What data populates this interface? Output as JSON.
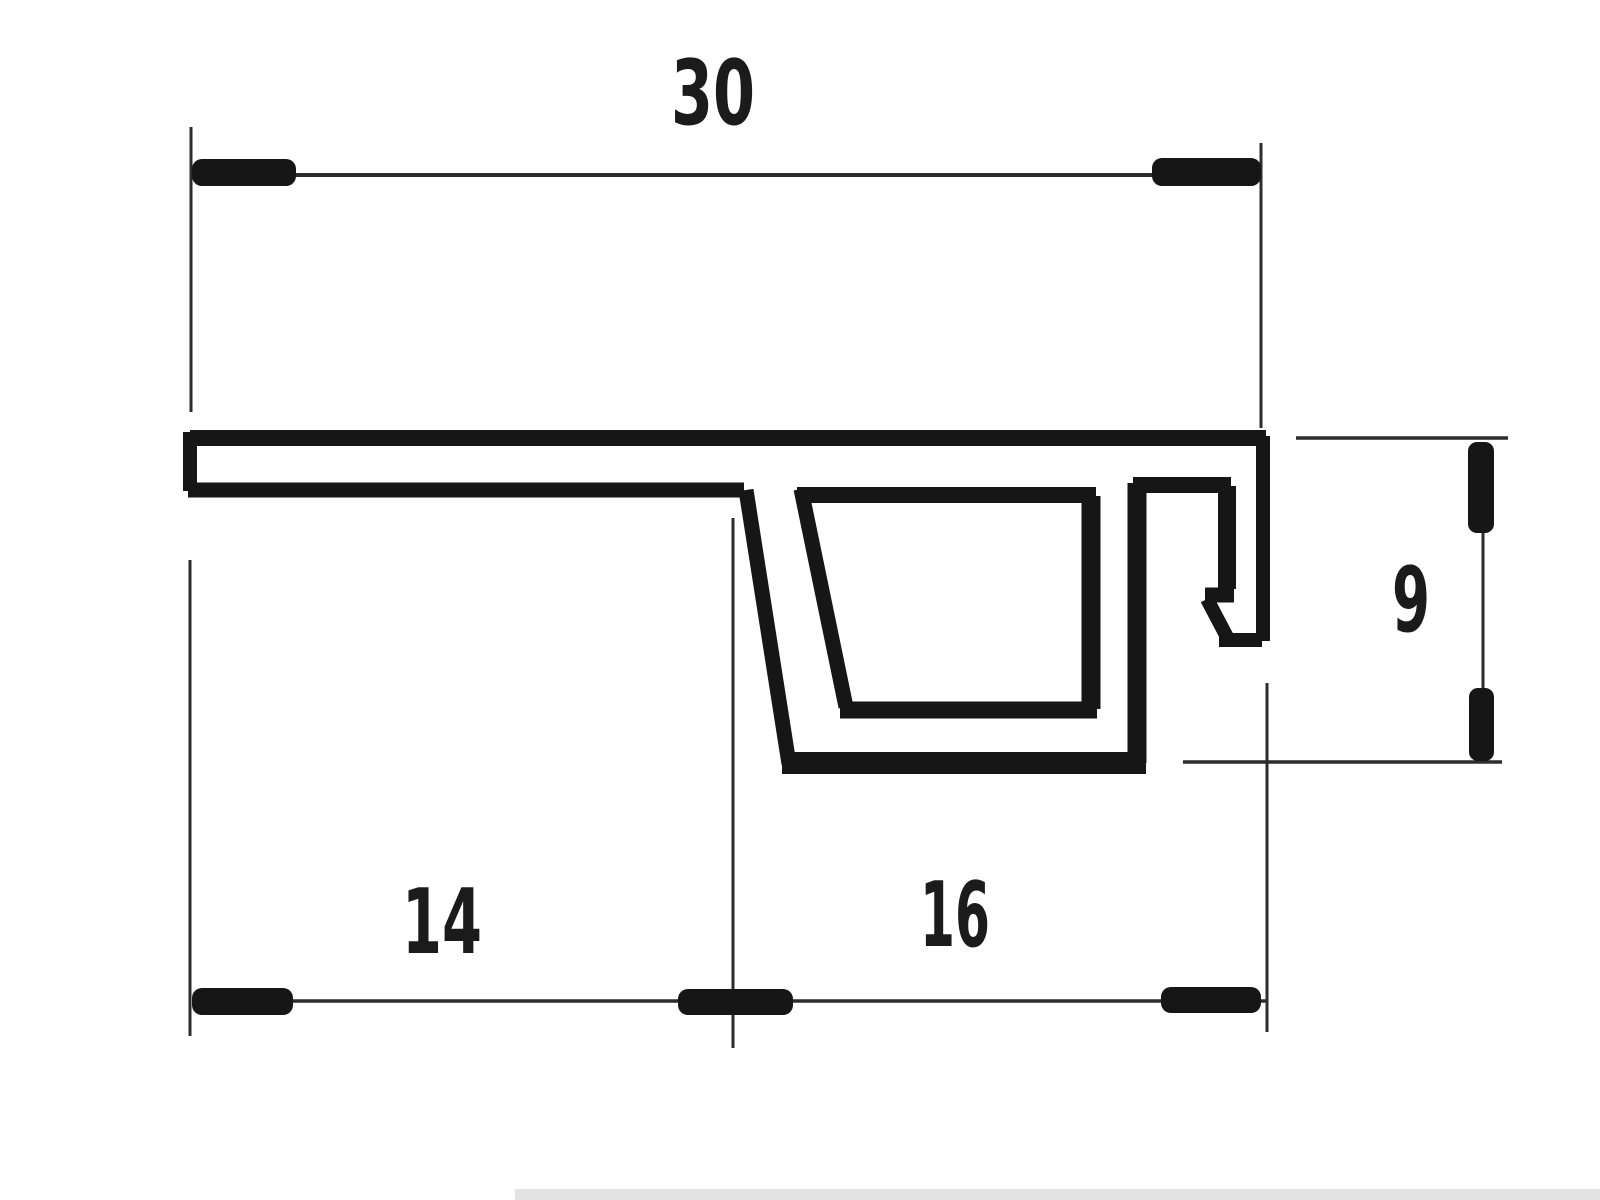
{
  "page": {
    "background": "#ffffff",
    "ink": "#161616",
    "thin_ink": "#2d2d2d",
    "label_color": "#1b1b1b",
    "shadow_color": "#d9d9d9"
  },
  "drawing": {
    "type": "technical-dimension-drawing",
    "subject": "extruded-profile-cross-section",
    "dimensions": [
      {
        "name": "overall-width",
        "value": "30"
      },
      {
        "name": "left-span",
        "value": "14"
      },
      {
        "name": "right-span",
        "value": "16"
      },
      {
        "name": "right-height",
        "value": "9"
      }
    ]
  },
  "labels": [
    {
      "id": "dimension-label-30",
      "text": "30",
      "x": 713,
      "baseline": 124,
      "font_size": 90,
      "text_length": 84
    },
    {
      "id": "dimension-label-14",
      "text": "14",
      "x": 442,
      "baseline": 953,
      "font_size": 90,
      "text_length": 80
    },
    {
      "id": "dimension-label-16",
      "text": "16",
      "x": 955,
      "baseline": 946,
      "font_size": 90,
      "text_length": 70
    },
    {
      "id": "dimension-label-9",
      "text": "9",
      "x": 1411,
      "baseline": 631,
      "font_size": 90,
      "text_length": 38
    }
  ],
  "profile_strokes": [
    {
      "name": "profile-top-edge",
      "x1": 190,
      "y1": 438,
      "x2": 1266,
      "y2": 438,
      "w": 16
    },
    {
      "name": "profile-left-end-cap",
      "x1": 190,
      "y1": 432,
      "x2": 190,
      "y2": 491,
      "w": 14
    },
    {
      "name": "flange-bottom-edge",
      "x1": 188,
      "y1": 490,
      "x2": 744,
      "y2": 490,
      "w": 15
    },
    {
      "name": "channel-left-wall-outer",
      "x1": 746,
      "y1": 490,
      "x2": 789,
      "y2": 764,
      "w": 15
    },
    {
      "name": "channel-bottom-outer",
      "x1": 782,
      "y1": 763,
      "x2": 1146,
      "y2": 763,
      "w": 22
    },
    {
      "name": "channel-right-wall-outer",
      "x1": 1137,
      "y1": 763,
      "x2": 1137,
      "y2": 483,
      "w": 19
    },
    {
      "name": "channel-left-wall-inner",
      "x1": 801,
      "y1": 489,
      "x2": 846,
      "y2": 707,
      "w": 15
    },
    {
      "name": "channel-top-edge-inner",
      "x1": 797,
      "y1": 495,
      "x2": 1096,
      "y2": 495,
      "w": 16
    },
    {
      "name": "channel-bottom-inner",
      "x1": 840,
      "y1": 710,
      "x2": 1097,
      "y2": 710,
      "w": 17
    },
    {
      "name": "channel-right-wall-inner",
      "x1": 1091,
      "y1": 496,
      "x2": 1091,
      "y2": 709,
      "w": 19
    },
    {
      "name": "hook-top-bar",
      "x1": 1133,
      "y1": 485,
      "x2": 1231,
      "y2": 485,
      "w": 16
    },
    {
      "name": "hook-inner-vertical",
      "x1": 1227,
      "y1": 486,
      "x2": 1227,
      "y2": 589,
      "w": 18
    },
    {
      "name": "hook-barb-step",
      "x1": 1205,
      "y1": 595,
      "x2": 1234,
      "y2": 595,
      "w": 15
    },
    {
      "name": "hook-barb-diagonal",
      "x1": 1207,
      "y1": 599,
      "x2": 1227,
      "y2": 637,
      "w": 14
    },
    {
      "name": "hook-foot",
      "x1": 1219,
      "y1": 640,
      "x2": 1262,
      "y2": 640,
      "w": 14
    },
    {
      "name": "profile-right-wall",
      "x1": 1263,
      "y1": 641,
      "x2": 1263,
      "y2": 436,
      "w": 14
    }
  ],
  "thin_lines": [
    {
      "name": "dimension-line-30",
      "x1": 194,
      "y1": 175,
      "x2": 1262,
      "y2": 175,
      "w": 4
    },
    {
      "name": "extension-line-30-left",
      "x1": 191,
      "y1": 127,
      "x2": 191,
      "y2": 412,
      "w": 3
    },
    {
      "name": "extension-line-30-right",
      "x1": 1261,
      "y1": 143,
      "x2": 1261,
      "y2": 428,
      "w": 3
    },
    {
      "name": "dimension-line-bottom",
      "x1": 192,
      "y1": 1001,
      "x2": 1266,
      "y2": 1001,
      "w": 3.5
    },
    {
      "name": "extension-line-bottom-left",
      "x1": 190,
      "y1": 560,
      "x2": 190,
      "y2": 1036,
      "w": 3
    },
    {
      "name": "extension-line-bottom-middle",
      "x1": 733,
      "y1": 518,
      "x2": 733,
      "y2": 1048,
      "w": 3
    },
    {
      "name": "extension-line-bottom-right",
      "x1": 1267,
      "y1": 683,
      "x2": 1267,
      "y2": 1032,
      "w": 3
    },
    {
      "name": "reference-line-9-top",
      "x1": 1296,
      "y1": 438,
      "x2": 1508,
      "y2": 438,
      "w": 3.5
    },
    {
      "name": "reference-line-9-bottom",
      "x1": 1183,
      "y1": 762,
      "x2": 1502,
      "y2": 762,
      "w": 3.5
    },
    {
      "name": "dimension-line-9",
      "x1": 1483,
      "y1": 442,
      "x2": 1483,
      "y2": 762,
      "w": 3
    }
  ],
  "ticks": [
    {
      "name": "tick-30-left",
      "x": 192,
      "y": 159,
      "w": 104,
      "h": 27,
      "rx": 10
    },
    {
      "name": "tick-30-right",
      "x": 1152,
      "y": 158,
      "w": 109,
      "h": 28,
      "rx": 10
    },
    {
      "name": "tick-bottom-left",
      "x": 192,
      "y": 988,
      "w": 101,
      "h": 27,
      "rx": 10
    },
    {
      "name": "tick-bottom-middle",
      "x": 678,
      "y": 989,
      "w": 115,
      "h": 26,
      "rx": 10
    },
    {
      "name": "tick-bottom-right",
      "x": 1161,
      "y": 987,
      "w": 100,
      "h": 26,
      "rx": 10
    },
    {
      "name": "tick-9-top",
      "x": 1468,
      "y": 442,
      "w": 26,
      "h": 91,
      "rx": 9
    },
    {
      "name": "tick-9-bottom",
      "x": 1469,
      "y": 688,
      "w": 25,
      "h": 73,
      "rx": 9
    }
  ],
  "artifacts": {
    "bottom_scan_shadow": {
      "x": 515,
      "y": 1189,
      "w": 1085,
      "h": 11
    }
  }
}
